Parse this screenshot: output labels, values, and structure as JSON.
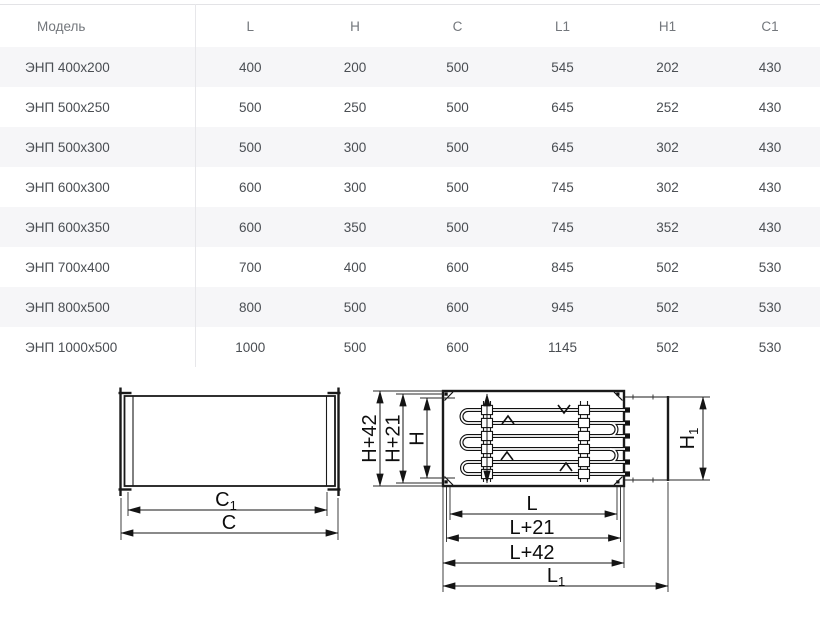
{
  "table": {
    "header": {
      "model": "Модель",
      "cols": [
        "L",
        "H",
        "C",
        "L1",
        "H1",
        "C1"
      ]
    },
    "rows": [
      {
        "model": "ЭНП 400х200",
        "values": [
          400,
          200,
          500,
          545,
          202,
          430
        ]
      },
      {
        "model": "ЭНП 500х250",
        "values": [
          500,
          250,
          500,
          645,
          252,
          430
        ]
      },
      {
        "model": "ЭНП 500х300",
        "values": [
          500,
          300,
          500,
          645,
          302,
          430
        ]
      },
      {
        "model": "ЭНП 600х300",
        "values": [
          600,
          300,
          500,
          745,
          302,
          430
        ]
      },
      {
        "model": "ЭНП 600х350",
        "values": [
          600,
          350,
          500,
          745,
          352,
          430
        ]
      },
      {
        "model": "ЭНП 700х400",
        "values": [
          700,
          400,
          600,
          845,
          502,
          530
        ]
      },
      {
        "model": "ЭНП 800х500",
        "values": [
          800,
          500,
          600,
          945,
          502,
          530
        ]
      },
      {
        "model": "ЭНП 1000х500",
        "values": [
          1000,
          500,
          600,
          1145,
          502,
          530
        ]
      }
    ]
  },
  "diagrams": {
    "duct_side_view": {
      "dim_c1": {
        "base": "C",
        "sub": "1"
      },
      "dim_c": {
        "base": "C"
      }
    },
    "heater_top_view": {
      "dim_h42": "H+42",
      "dim_h21": "H+21",
      "dim_h": "H",
      "dim_h1": {
        "base": "H",
        "sub": "1"
      },
      "dim_l": "L",
      "dim_l21": "L+21",
      "dim_l42": "L+42",
      "dim_l1": {
        "base": "L",
        "sub": "1"
      }
    }
  },
  "colors": {
    "row_stripe": "#f6f6f8",
    "table_border": "#e7e7ea",
    "header_text": "#73777c",
    "cell_text": "#4a4e53",
    "drawing_line": "#1a1a1a"
  }
}
